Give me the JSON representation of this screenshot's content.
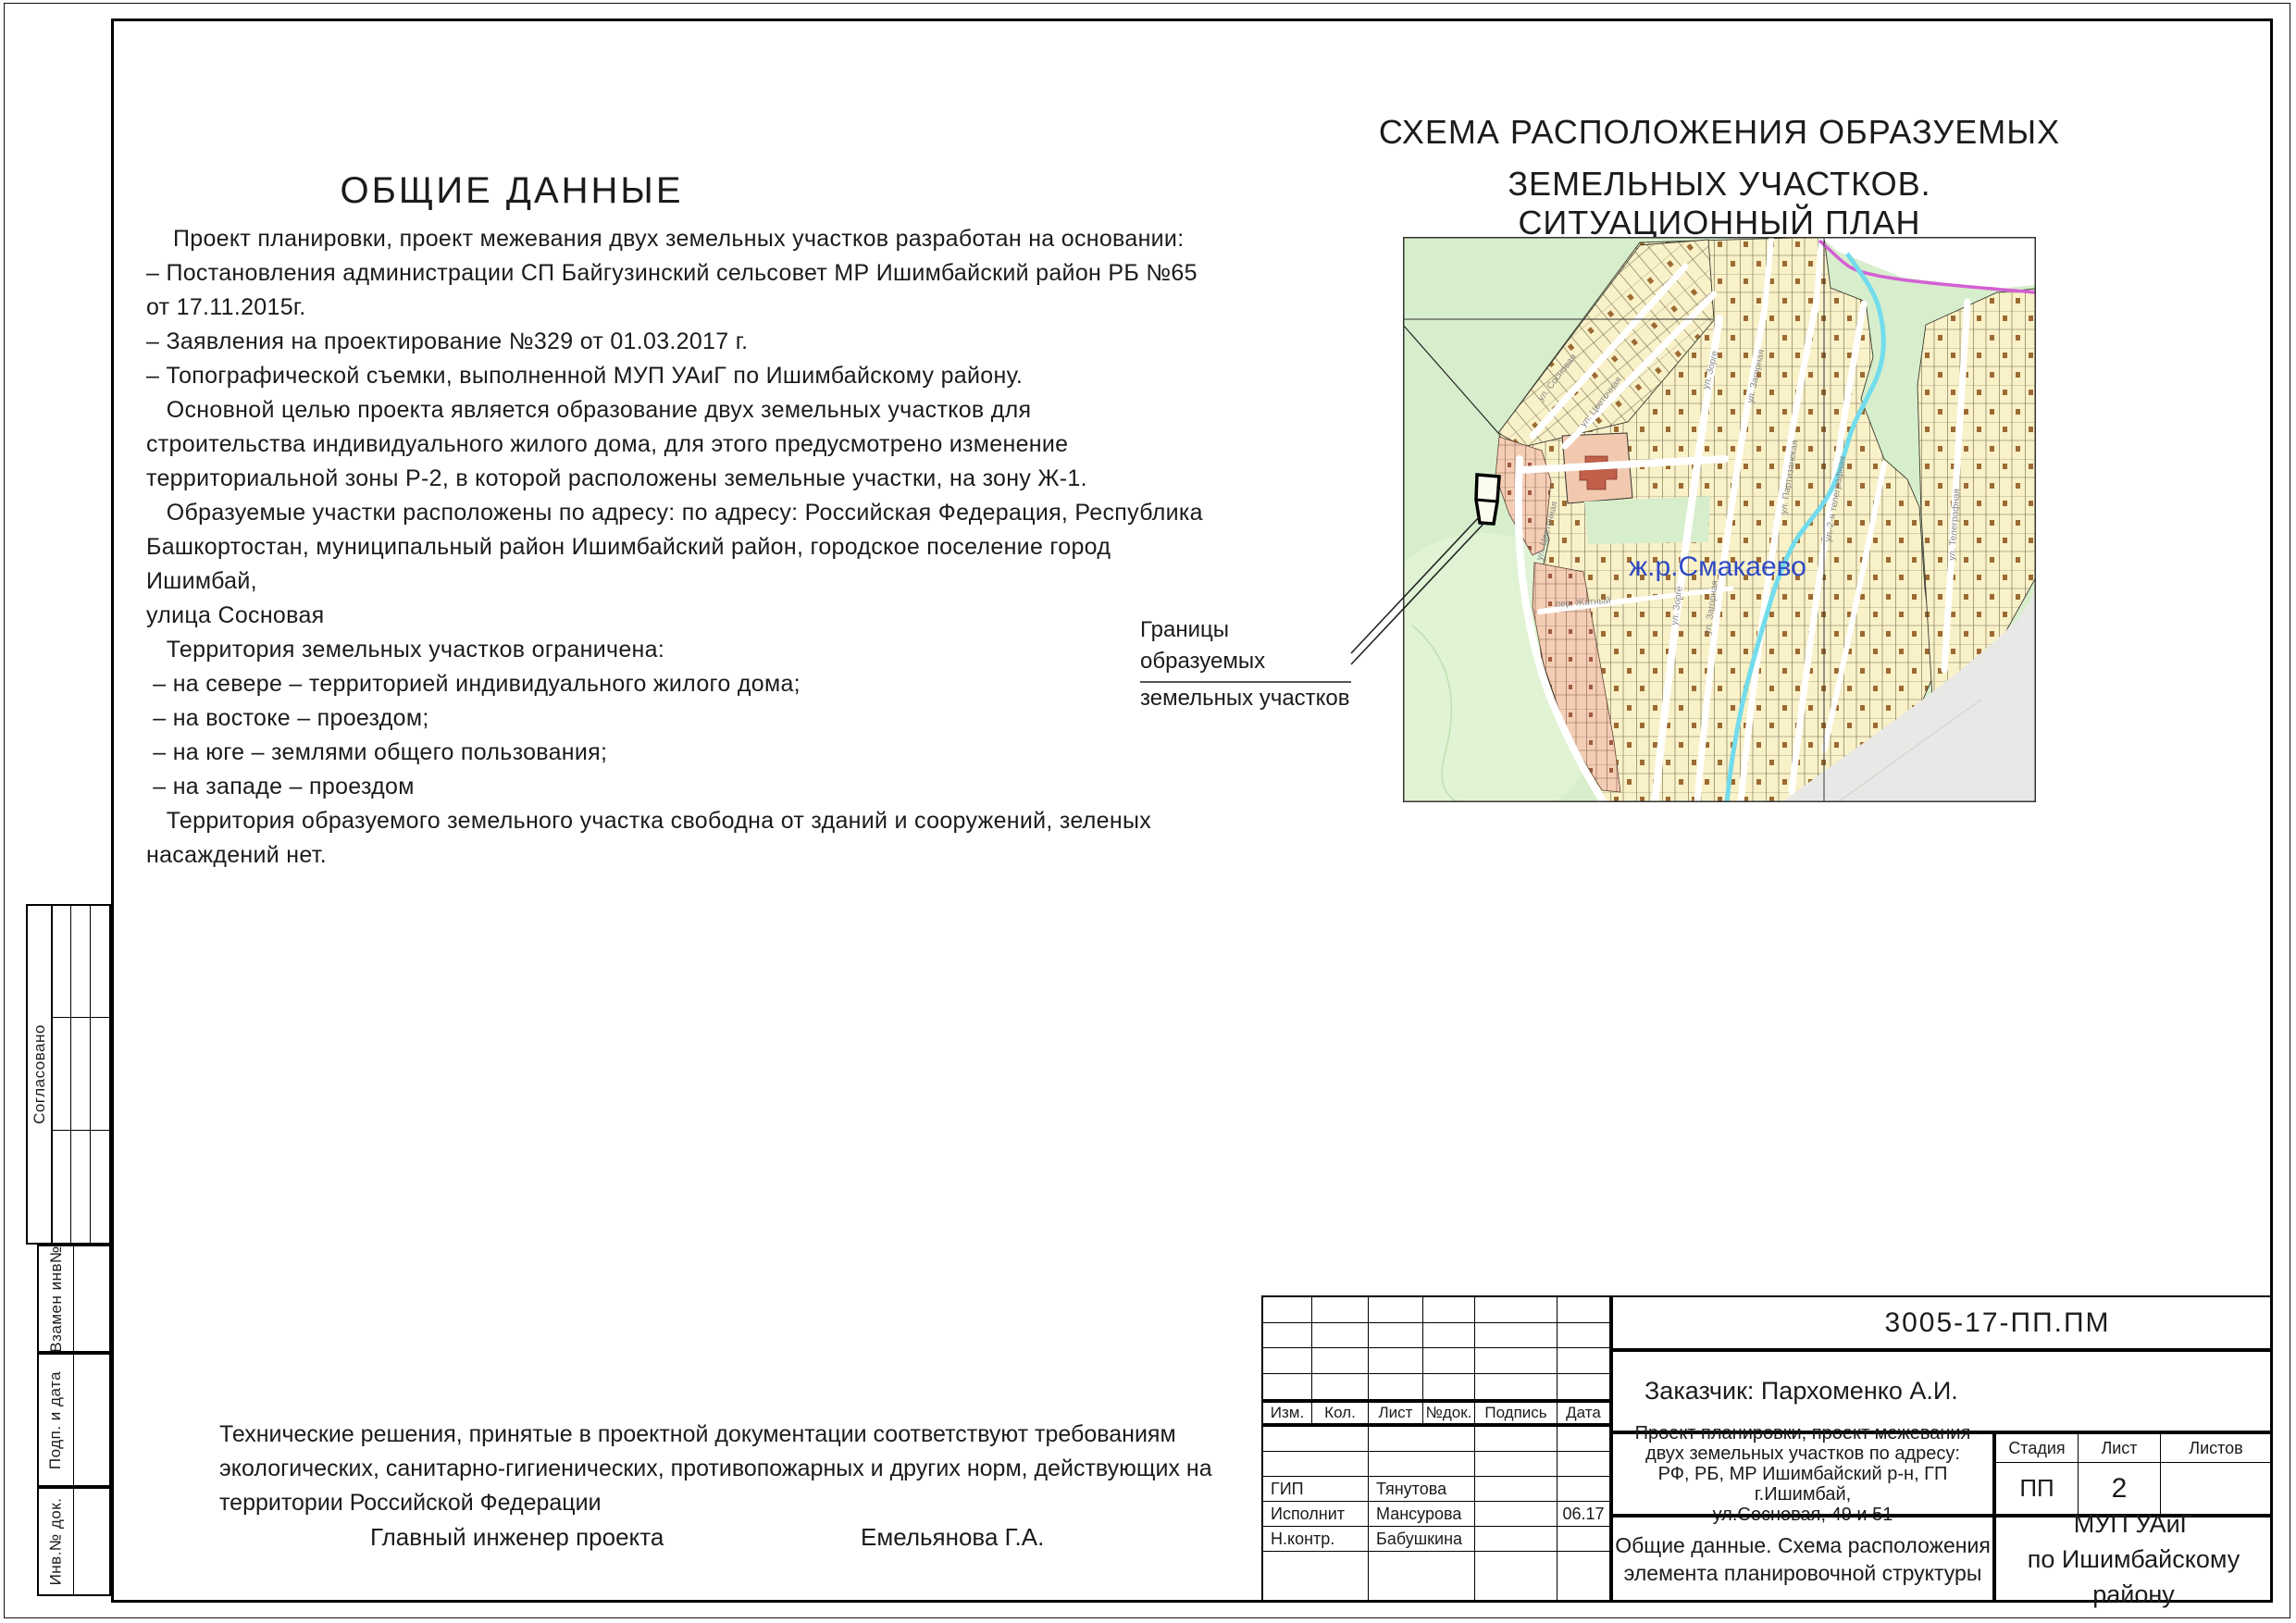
{
  "general": {
    "heading": "ОБЩИЕ ДАННЫЕ",
    "body": "    Проект планировки, проект межевания двух земельных участков разработан на основании:\n– Постановления администрации СП Байгузинский сельсовет МР Ишимбайский район РБ №65\nот 17.11.2015г.\n– Заявления на проектирование №329 от 01.03.2017 г.\n– Топографической съемки, выполненной МУП УАиГ по Ишимбайскому району.\n   Основной целью проекта является образование двух земельных участков для\nстроительства индивидуального жилого дома, для этого предусмотрено изменение\nтерриториальной зоны Р-2, в которой расположены земельные участки, на зону Ж-1.\n   Образуемые участки расположены по адресу: по адресу: Российская Федерация, Республика\nБашкортостан, муниципальный район Ишимбайский район, городское поселение город Ишимбай,\nулица Сосновая\n   Территория земельных участков ограничена:\n – на севере – территорией индивидуального жилого дома;\n – на востоке – проездом;\n – на юге – землями общего пользования;\n – на западе – проездом\n   Территория образуемого земельного участка свободна от зданий и сооружений, зеленых\nнасаждений нет."
  },
  "note": {
    "text": "Технические решения, принятые в проектной документации соответствуют требованиям\nэкологических, санитарно-гигиенических, противопожарных и других норм, действующих на\nтерритории Российской Федерации",
    "role": "Главный инженер проекта",
    "name": "Емельянова Г.А."
  },
  "scheme": {
    "title_line1": "СХЕМА РАСПОЛОЖЕНИЯ ОБРАЗУЕМЫХ",
    "title_line2": "ЗЕМЕЛЬНЫХ УЧАСТКОВ. СИТУАЦИОННЫЙ ПЛАН",
    "district_label": "ж.р.Смакаево",
    "callout_line1": "Границы образуемых",
    "callout_line2": "земельных участков",
    "streets": [
      "ул. Сосновая",
      "ул. Цветочная",
      "ул. Зорге",
      "ул. Загорная",
      "ул. Партизанская",
      "ул. 2-я телеграфная",
      "ул. Телеграфная",
      "пер. Жатный",
      "ул. Цветочная",
      "ул. Зорге",
      "ул. Загорная"
    ]
  },
  "frame_labels": {
    "approved": "Согласовано",
    "replaced_inv": "Взамен инв№",
    "sign_date": "Подп. и дата",
    "inv_doc": "Инв.№ док."
  },
  "title_block": {
    "doc_number": "3005-17-ПП.ПМ",
    "customer": "Заказчик: Пархоменко А.И.",
    "rev_headers": [
      "Изм.",
      "Кол.",
      "Лист",
      "№док.",
      "Подпись",
      "Дата"
    ],
    "staff": [
      {
        "role": "ГИП",
        "name": "Тянутова",
        "date": ""
      },
      {
        "role": "Исполнит",
        "name": "Мансурова",
        "date": "06.17"
      },
      {
        "role": "Н.контр.",
        "name": "Бабушкина",
        "date": ""
      }
    ],
    "project_name_lines": [
      "Проект планировки, проект межевания",
      "двух земельных участков по адресу:",
      "РФ, РБ, МР Ишимбайский р-н, ГП г.Ишимбай,",
      "ул.Сосновая, 49 и 51"
    ],
    "stage_label": "Стадия",
    "sheet_label": "Лист",
    "sheets_label": "Листов",
    "stage": "ПП",
    "sheet": "2",
    "sheets": "",
    "sheet_title_line1": "Общие данные. Схема расположения",
    "sheet_title_line2": "элемента планировочной структуры",
    "org_line1": "МУП  УАиГ",
    "org_line2": "по Ишимбайскому району"
  },
  "colors": {
    "map_green": "#d7eecd",
    "parcel_cream": "#f9f1c8",
    "parcel_salmon": "#f5cdb5",
    "stream": "#72dcec",
    "boundary_magenta": "#d45fd4",
    "district_label_blue": "#2f49c3"
  }
}
